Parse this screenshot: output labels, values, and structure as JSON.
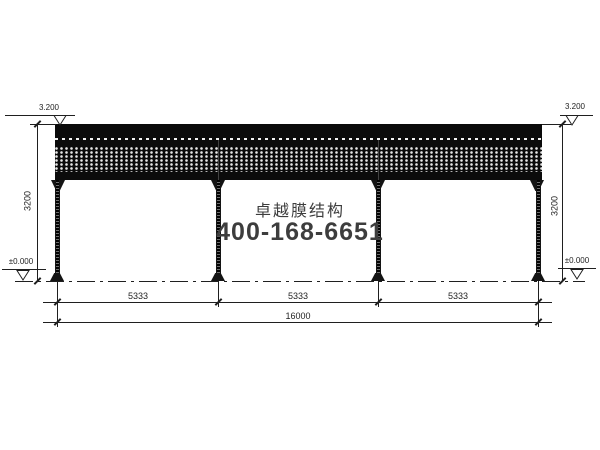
{
  "watermark": {
    "brand": "卓越膜结构",
    "phone": "400-168-6651",
    "color": "#3d3d3d"
  },
  "levels": {
    "roof": "3.200",
    "ground": "±0.000"
  },
  "dims": {
    "height": "3200",
    "bays": [
      "5333",
      "5333",
      "5333"
    ],
    "total": "16000"
  },
  "colors": {
    "ink": "#1f1f1f",
    "background": "#ffffff"
  }
}
